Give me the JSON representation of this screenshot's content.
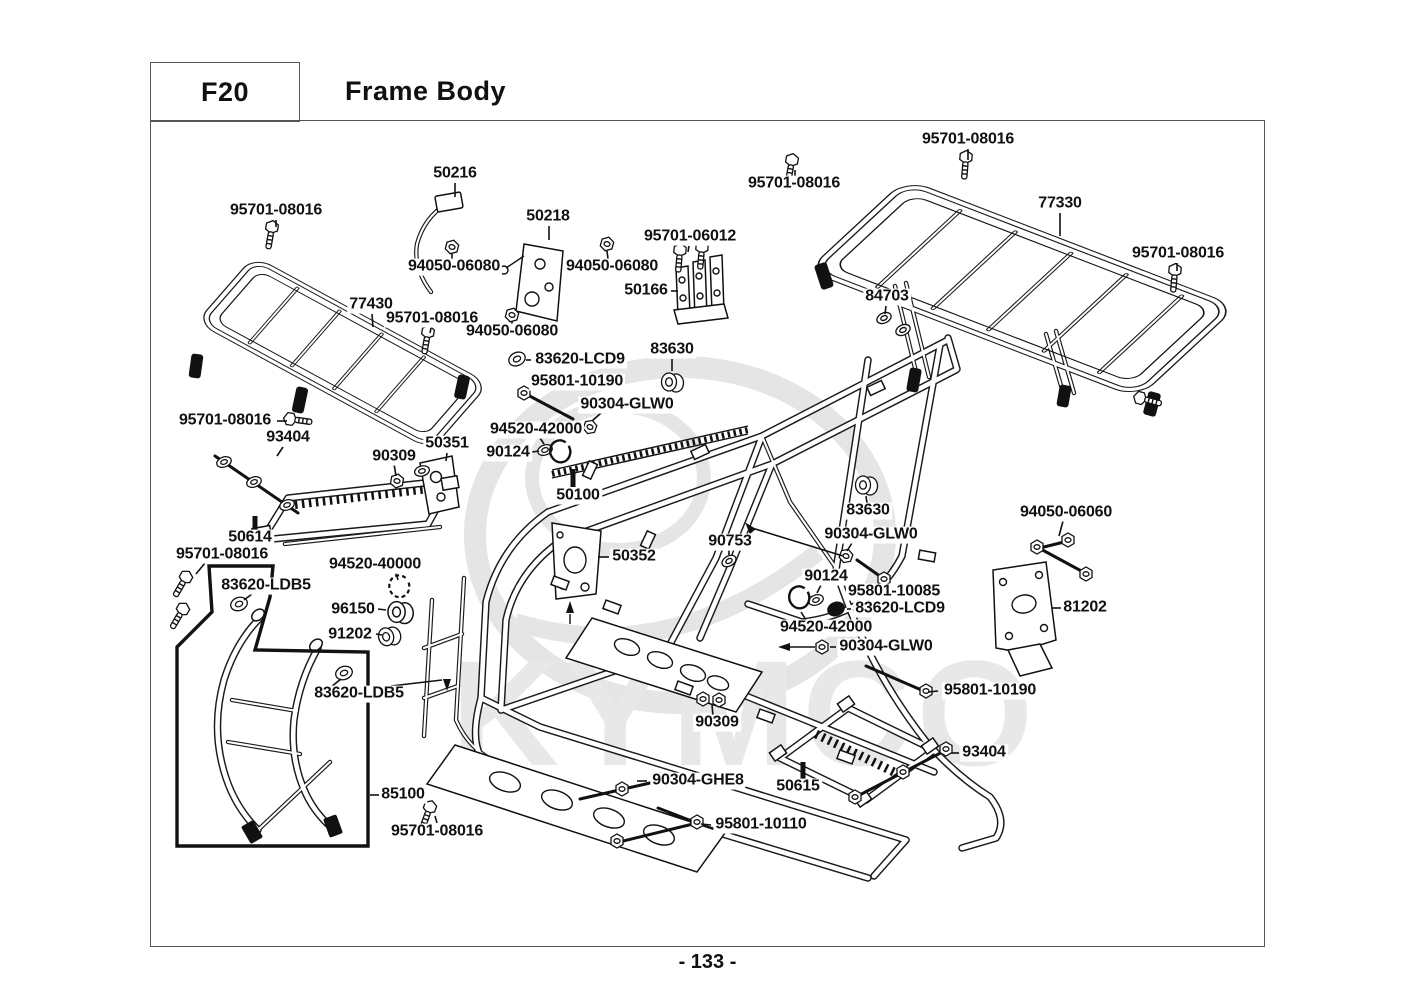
{
  "header": {
    "code": "F20",
    "title": "Frame Body"
  },
  "footer": {
    "page_number": "- 133 -"
  },
  "watermark": {
    "brand": "KYMCO"
  },
  "diagram": {
    "part_labels": [
      {
        "text": "95701-08016",
        "x": 968,
        "y": 140,
        "leader": [
          [
            968,
            149,
            968,
            160
          ]
        ]
      },
      {
        "text": "95701-08016",
        "x": 794,
        "y": 184,
        "leader": [
          [
            795,
            176,
            795,
            170
          ]
        ]
      },
      {
        "text": "77330",
        "x": 1060,
        "y": 204,
        "leader": [
          [
            1060,
            213,
            1060,
            236
          ]
        ]
      },
      {
        "text": "95701-08016",
        "x": 1178,
        "y": 254,
        "leader": [
          [
            1177,
            263,
            1177,
            271
          ]
        ]
      },
      {
        "text": "50216",
        "x": 455,
        "y": 174,
        "leader": [
          [
            455,
            183,
            455,
            197
          ]
        ]
      },
      {
        "text": "50218",
        "x": 548,
        "y": 217,
        "leader": [
          [
            549,
            226,
            549,
            240
          ]
        ]
      },
      {
        "text": "95701-08016",
        "x": 276,
        "y": 211,
        "leader": [
          [
            276,
            220,
            276,
            227
          ]
        ]
      },
      {
        "text": "94050-06080",
        "x": 454,
        "y": 267,
        "leader": [
          [
            452,
            259,
            452,
            253
          ]
        ]
      },
      {
        "text": "94050-06080",
        "x": 612,
        "y": 267,
        "leader": [
          [
            608,
            259,
            607,
            251
          ]
        ]
      },
      {
        "text": "95701-06012",
        "x": 690,
        "y": 237,
        "leader": [
          [
            689,
            246,
            688,
            252
          ]
        ]
      },
      {
        "text": "50166",
        "x": 646,
        "y": 291,
        "leader": [
          [
            671,
            291,
            678,
            291
          ]
        ]
      },
      {
        "text": "77430",
        "x": 371,
        "y": 305,
        "leader": [
          [
            372,
            314,
            373,
            327
          ]
        ]
      },
      {
        "text": "95701-08016",
        "x": 432,
        "y": 319,
        "leader": [
          [
            431,
            328,
            430,
            333
          ]
        ]
      },
      {
        "text": "94050-06080",
        "x": 512,
        "y": 332,
        "leader": [
          [
            512,
            325,
            512,
            321
          ]
        ]
      },
      {
        "text": "84703",
        "x": 887,
        "y": 297,
        "leader": [
          [
            886,
            306,
            885,
            314
          ]
        ]
      },
      {
        "text": "83630",
        "x": 672,
        "y": 350,
        "leader": [
          [
            672,
            359,
            672,
            371
          ]
        ]
      },
      {
        "text": "83620-LCD9",
        "x": 580,
        "y": 360,
        "leader": [
          [
            531,
            360,
            526,
            360
          ]
        ]
      },
      {
        "text": "95801-10190",
        "x": 577,
        "y": 382
      },
      {
        "text": "90304-GLW0",
        "x": 627,
        "y": 405,
        "leader": [
          [
            601,
            413,
            592,
            421
          ]
        ]
      },
      {
        "text": "94520-42000",
        "x": 536,
        "y": 430,
        "leader": [
          [
            540,
            438,
            544,
            444
          ]
        ]
      },
      {
        "text": "90124",
        "x": 508,
        "y": 453,
        "leader": [
          [
            532,
            452,
            539,
            451
          ]
        ]
      },
      {
        "text": "95701-08016",
        "x": 225,
        "y": 421,
        "leader": [
          [
            277,
            421,
            287,
            421
          ]
        ]
      },
      {
        "text": "93404",
        "x": 288,
        "y": 438,
        "leader": [
          [
            283,
            447,
            277,
            456
          ]
        ]
      },
      {
        "text": "90309",
        "x": 394,
        "y": 457,
        "leader": [
          [
            394,
            464,
            396,
            476
          ]
        ]
      },
      {
        "text": "50351",
        "x": 447,
        "y": 444,
        "leader": [
          [
            447,
            453,
            446,
            461
          ]
        ]
      },
      {
        "text": "50100",
        "x": 578,
        "y": 496,
        "leader_style": "bar",
        "leader": [
          [
            573,
            469,
            573,
            487
          ]
        ]
      },
      {
        "text": "83630",
        "x": 868,
        "y": 511,
        "leader": [
          [
            867,
            503,
            866,
            496
          ]
        ]
      },
      {
        "text": "94050-06060",
        "x": 1066,
        "y": 513,
        "leader": [
          [
            1063,
            521,
            1059,
            536
          ]
        ]
      },
      {
        "text": "50614",
        "x": 250,
        "y": 538,
        "leader_style": "bar",
        "leader": [
          [
            255,
            516,
            255,
            530
          ]
        ]
      },
      {
        "text": "95701-08016",
        "x": 222,
        "y": 555,
        "leader": [
          [
            205,
            563,
            196,
            574
          ]
        ]
      },
      {
        "text": "83620-LDB5",
        "x": 266,
        "y": 586,
        "leader": [
          [
            252,
            594,
            244,
            600
          ]
        ]
      },
      {
        "text": "94520-40000",
        "x": 375,
        "y": 565,
        "leader": [
          [
            396,
            573,
            398,
            580
          ]
        ]
      },
      {
        "text": "50352",
        "x": 634,
        "y": 557,
        "leader": [
          [
            609,
            557,
            598,
            557
          ]
        ]
      },
      {
        "text": "90753",
        "x": 730,
        "y": 542,
        "leader": [
          [
            729,
            550,
            729,
            555
          ]
        ]
      },
      {
        "text": "90304-GLW0",
        "x": 871,
        "y": 535,
        "leader": [
          [
            852,
            543,
            847,
            551
          ],
          [
            843,
            556,
            752,
            528
          ]
        ]
      },
      {
        "text": "90124",
        "x": 826,
        "y": 577,
        "leader": [
          [
            821,
            585,
            817,
            593
          ]
        ]
      },
      {
        "text": "95801-10085",
        "x": 894,
        "y": 592
      },
      {
        "text": "83620-LCD9",
        "x": 900,
        "y": 609,
        "leader": [
          [
            851,
            609,
            847,
            609
          ]
        ]
      },
      {
        "text": "81202",
        "x": 1085,
        "y": 608,
        "leader": [
          [
            1061,
            608,
            1052,
            608
          ]
        ]
      },
      {
        "text": "94520-42000",
        "x": 826,
        "y": 628,
        "leader": [
          [
            806,
            620,
            801,
            612
          ]
        ]
      },
      {
        "text": "90304-GLW0",
        "x": 886,
        "y": 647,
        "leader": [
          [
            836,
            647,
            830,
            647
          ],
          [
            815,
            647,
            790,
            647
          ]
        ]
      },
      {
        "text": "96150",
        "x": 353,
        "y": 610,
        "leader": [
          [
            378,
            609,
            386,
            610
          ]
        ]
      },
      {
        "text": "91202",
        "x": 350,
        "y": 635,
        "leader": [
          [
            376,
            634,
            382,
            635
          ]
        ]
      },
      {
        "text": "83620-LDB5",
        "x": 359,
        "y": 694,
        "leader": [
          [
            331,
            687,
            341,
            679
          ],
          [
            391,
            686,
            442,
            680
          ]
        ]
      },
      {
        "text": "95801-10190",
        "x": 990,
        "y": 691,
        "leader": [
          [
            938,
            691,
            928,
            692
          ]
        ]
      },
      {
        "text": "90309",
        "x": 717,
        "y": 723,
        "leader": [
          [
            713,
            716,
            712,
            705
          ]
        ]
      },
      {
        "text": "93404",
        "x": 984,
        "y": 753,
        "leader": [
          [
            959,
            753,
            951,
            753
          ]
        ]
      },
      {
        "text": "50615",
        "x": 798,
        "y": 787,
        "leader_style": "bar",
        "leader": [
          [
            803,
            762,
            803,
            779
          ]
        ]
      },
      {
        "text": "90304-GHE8",
        "x": 698,
        "y": 781,
        "leader": [
          [
            647,
            781,
            637,
            781
          ]
        ]
      },
      {
        "text": "85100",
        "x": 403,
        "y": 795,
        "leader": [
          [
            379,
            795,
            370,
            795
          ]
        ]
      },
      {
        "text": "95701-08016",
        "x": 437,
        "y": 832,
        "leader": [
          [
            437,
            823,
            435,
            816
          ]
        ]
      },
      {
        "text": "95801-10110",
        "x": 761,
        "y": 825,
        "leader": [
          [
            711,
            825,
            701,
            824
          ]
        ]
      }
    ]
  }
}
